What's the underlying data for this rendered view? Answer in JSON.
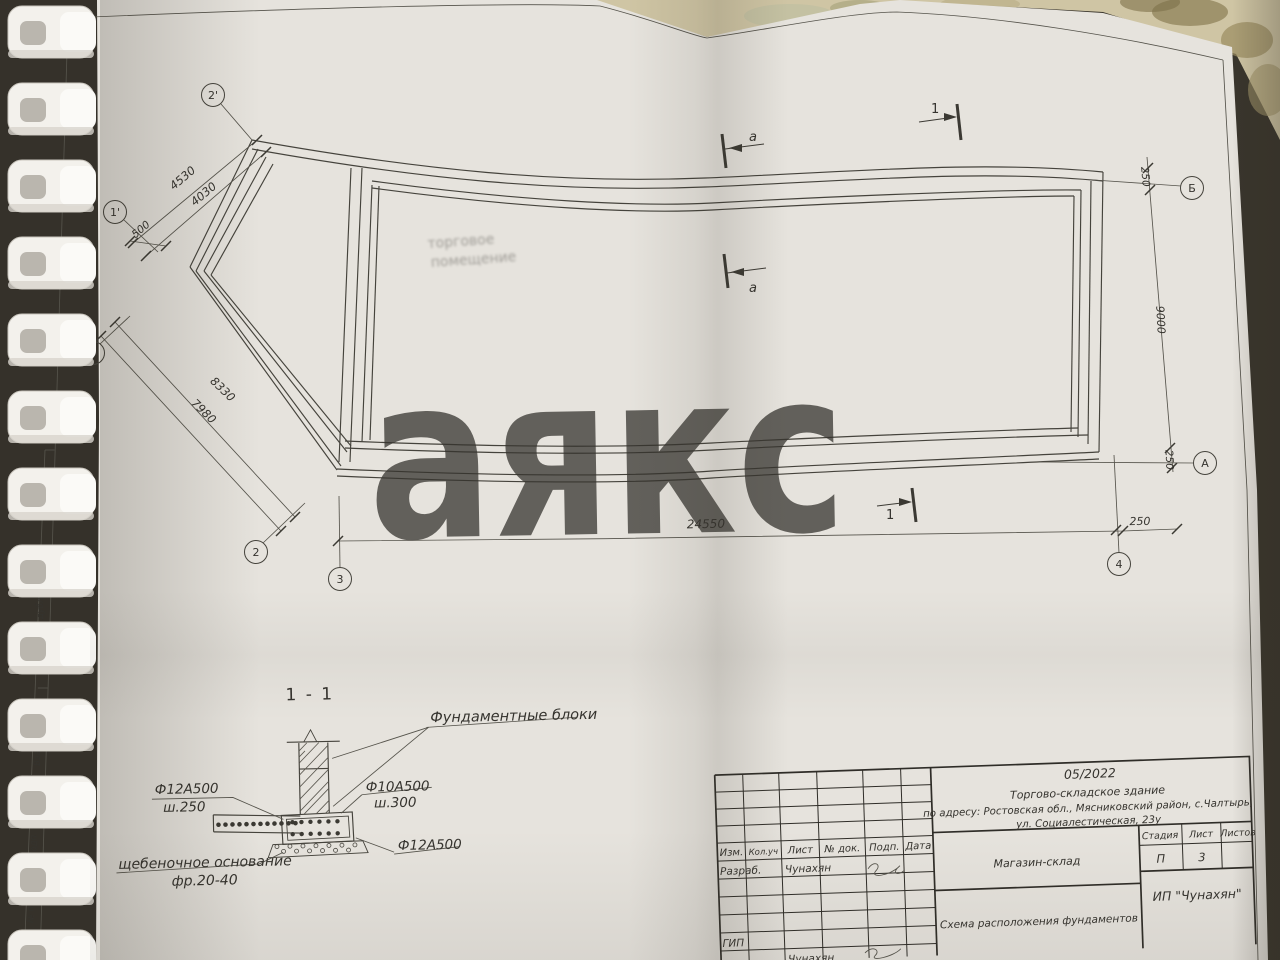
{
  "watermark": {
    "text": "аякс"
  },
  "ghost": {
    "line1": "торговое",
    "line2": "помещение"
  },
  "plan": {
    "dims": {
      "d4530": "4530",
      "d4030": "4030",
      "d500": "500",
      "d8330": "8330",
      "d7980": "7980",
      "d24550": "24550",
      "d250a": "250",
      "d250b": "250",
      "d250c": "250",
      "d9000": "9000"
    },
    "axes": {
      "x2p": "2'",
      "x1p": "1'",
      "x1": "1",
      "x2": "2",
      "x3": "3",
      "x4": "4",
      "yA": "А",
      "yB": "Б"
    },
    "marks": {
      "sec_a": "а",
      "sec_1": "1"
    }
  },
  "detail": {
    "title": "1 - 1",
    "blocks_label": "Фундаментные блоки",
    "rebar_left1": "Ф12А500",
    "rebar_left2": "ш.250",
    "rebar_right1": "Ф10А500",
    "rebar_right2": "ш.300",
    "rebar_bottom": "Ф12А500",
    "base1": "щебеночное основание",
    "base2": "фр.20-40"
  },
  "titleblock": {
    "date": "05/2022",
    "line1": "Торгово-складское здание",
    "line2": "по адресу: Ростовская обл., Мясниковский район, с.Чалтырь,",
    "line3": "ул. Социалестическая, 23у",
    "object": "Магазин-склад",
    "drawing": "Схема расположения фундаментов",
    "company": "ИП \"Чунахян\"",
    "h_izm": "Изм.",
    "h_koluch": "Кол.уч",
    "h_list": "Лист",
    "h_ndok": "№ док.",
    "h_podp": "Подп.",
    "h_data": "Дата",
    "h_stadia": "Стадия",
    "h_list2": "Лист",
    "h_listov": "Листов",
    "v_stadia": "П",
    "v_list": "3",
    "r_razrab": "Разраб.",
    "r_razrab_name": "Чунахян",
    "r_gip": "ГИП"
  },
  "sidestamp": {
    "l1": "Инв. № дубл.",
    "l2": "Взам. инв. №",
    "l3": "Подп. и дата",
    "l4": "Инв. № подл."
  }
}
